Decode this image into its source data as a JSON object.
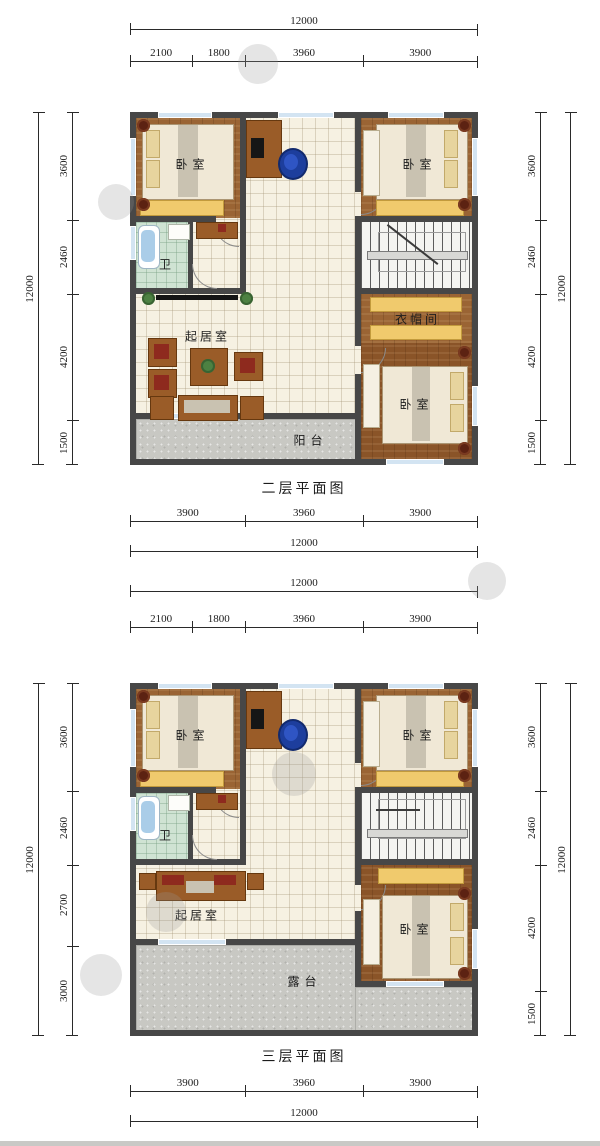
{
  "plans": [
    {
      "title": "二层平面图",
      "dims": {
        "top_total": "12000",
        "top_segments": [
          "2100",
          "1800",
          "3960",
          "3900"
        ],
        "bottom_total": "12000",
        "bottom_segments": [
          "3900",
          "3960",
          "3900"
        ],
        "left_total": "12000",
        "left_segments": [
          "3600",
          "2460",
          "4200",
          "1500"
        ],
        "right_total": "12000",
        "right_segments": [
          "3600",
          "2460",
          "4200",
          "1500"
        ]
      },
      "rooms": {
        "bedroom_tl": "卧室",
        "bedroom_tr": "卧室",
        "bedroom_br": "卧室",
        "bath": "卫",
        "living": "起居室",
        "cloak": "衣帽间",
        "balcony": "阳台"
      }
    },
    {
      "title": "三层平面图",
      "dims": {
        "top_total": "12000",
        "top_segments": [
          "2100",
          "1800",
          "3960",
          "3900"
        ],
        "bottom_total": "12000",
        "bottom_segments": [
          "3900",
          "3960",
          "3900"
        ],
        "left_total": "12000",
        "left_segments": [
          "3600",
          "2460",
          "2700",
          "3000"
        ],
        "right_total": "12000",
        "right_segments": [
          "3600",
          "2460",
          "4200",
          "1500"
        ]
      },
      "rooms": {
        "bedroom_tl": "卧室",
        "bedroom_tr": "卧室",
        "bedroom_br": "卧室",
        "bath": "卫",
        "living": "起居室",
        "terrace": "露台"
      }
    }
  ],
  "colors": {
    "wall": "#474747",
    "wood_floor": "#9a6434",
    "tile_floor": "#f6f1e2",
    "bath_floor": "#cfe3d3",
    "terrace_floor": "#c8c8c3",
    "window": "#d3e4f2",
    "wardrobe_yellow": "#f0ca6d",
    "desk_chair_blue": "#1d3e9d",
    "dimension_line": "#2a2a2a"
  }
}
